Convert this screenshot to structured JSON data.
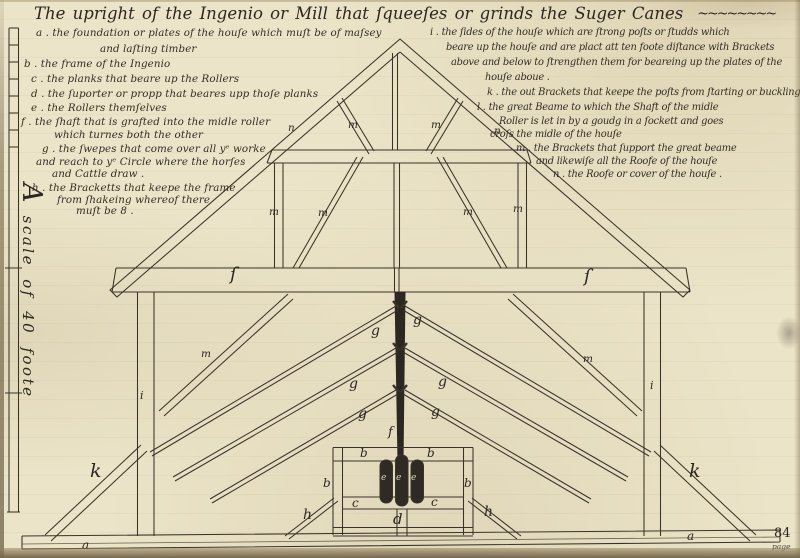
{
  "colors": {
    "paper": "#ece4c8",
    "ink": "#3a3328",
    "ink_dark": "#2c2720",
    "page_edge": "#75684e",
    "roller_fill": "#2f2a23",
    "label_light": "#d9d1b6"
  },
  "title": {
    "text": "The upright of the Ingenio or Mill that ſqueeſes or grinds the Suger Canes",
    "flourish": "~~~~~~~~"
  },
  "scale_note": {
    "text": "A scale of 40 foote"
  },
  "page": {
    "number": "84",
    "word": "page"
  },
  "legend_left": {
    "lines": [
      {
        "text": "a . the foundation or plates of the houſe which muſt be of maſsey",
        "x": 36,
        "y": 27
      },
      {
        "text": "and laſting timber",
        "x": 100,
        "y": 43
      },
      {
        "text": "b . the frame of the Ingenio",
        "x": 24,
        "y": 58
      },
      {
        "text": "c . the planks that beare up the Rollers",
        "x": 31,
        "y": 73
      },
      {
        "text": "d . the ſuporter or propp that beares upp thoſe planks",
        "x": 31,
        "y": 88
      },
      {
        "text": "e . the Rollers themſelves",
        "x": 31,
        "y": 102
      },
      {
        "text": "f . the ſhaft that is grafted into the midle roller",
        "x": 21,
        "y": 116
      },
      {
        "text": "which turnes both the other",
        "x": 54,
        "y": 129
      },
      {
        "text": "g . the ſwepes that come over all yᵉ worke",
        "x": 42,
        "y": 143
      },
      {
        "text": "and reach to yᵉ Circle where the horſes",
        "x": 36,
        "y": 156
      },
      {
        "text": "and Cattle draw .",
        "x": 52,
        "y": 168
      },
      {
        "text": "h . the Bracketts that keepe the frame",
        "x": 32,
        "y": 182
      },
      {
        "text": "from ſhakeing whereof there",
        "x": 57,
        "y": 194
      },
      {
        "text": "muſt be 8 .",
        "x": 76,
        "y": 205
      }
    ]
  },
  "legend_right": {
    "lines": [
      {
        "text": "i . the ſides of the houſe which are ſtrong poſts or ſtudds which",
        "x": 430,
        "y": 27
      },
      {
        "text": "beare up the houſe and are plact att ten foote diſtance with Brackets",
        "x": 446,
        "y": 42
      },
      {
        "text": "above and below to ſtrengthen them for beareing up the plates of the",
        "x": 451,
        "y": 57
      },
      {
        "text": "houſe aboue .",
        "x": 485,
        "y": 72
      },
      {
        "text": "k . the out Brackets that keepe the poſts from ſtarting or buckling",
        "x": 487,
        "y": 87
      },
      {
        "text": "l . the great Beame to which the Shaft of the midle",
        "x": 477,
        "y": 102
      },
      {
        "text": "Roller is let in by a goudg in a ſockett and goes",
        "x": 499,
        "y": 116
      },
      {
        "text": "croſs the midle of the houſe",
        "x": 490,
        "y": 129
      },
      {
        "text": "m . the Brackets that ſupport the great beame",
        "x": 516,
        "y": 143
      },
      {
        "text": "and likewiſe all the Roofe of the houſe",
        "x": 536,
        "y": 156
      },
      {
        "text": "n . the Roofe or cover of the houſe .",
        "x": 553,
        "y": 169
      }
    ]
  },
  "diagram": {
    "labels": [
      {
        "t": "a",
        "x": 82,
        "y": 539,
        "fs": 12
      },
      {
        "t": "a",
        "x": 687,
        "y": 530,
        "fs": 12
      },
      {
        "t": "b",
        "x": 360,
        "y": 447,
        "fs": 12
      },
      {
        "t": "b",
        "x": 427,
        "y": 447,
        "fs": 12
      },
      {
        "t": "b",
        "x": 323,
        "y": 477,
        "fs": 12
      },
      {
        "t": "b",
        "x": 464,
        "y": 477,
        "fs": 12
      },
      {
        "t": "c",
        "x": 352,
        "y": 497,
        "fs": 12
      },
      {
        "t": "c",
        "x": 431,
        "y": 496,
        "fs": 12
      },
      {
        "t": "d",
        "x": 393,
        "y": 512,
        "fs": 15
      },
      {
        "t": "e",
        "x": 381,
        "y": 474,
        "fs": 9,
        "cls": "light"
      },
      {
        "t": "e",
        "x": 396,
        "y": 474,
        "fs": 9,
        "cls": "light"
      },
      {
        "t": "e",
        "x": 411,
        "y": 474,
        "fs": 9,
        "cls": "light"
      },
      {
        "t": "f",
        "x": 388,
        "y": 426,
        "fs": 13
      },
      {
        "t": "g",
        "x": 371,
        "y": 324,
        "fs": 14
      },
      {
        "t": "g",
        "x": 413,
        "y": 313,
        "fs": 14
      },
      {
        "t": "g",
        "x": 349,
        "y": 377,
        "fs": 14
      },
      {
        "t": "g",
        "x": 438,
        "y": 375,
        "fs": 14
      },
      {
        "t": "g",
        "x": 358,
        "y": 407,
        "fs": 14
      },
      {
        "t": "g",
        "x": 431,
        "y": 405,
        "fs": 14
      },
      {
        "t": "h",
        "x": 303,
        "y": 508,
        "fs": 14
      },
      {
        "t": "h",
        "x": 484,
        "y": 505,
        "fs": 14
      },
      {
        "t": "i",
        "x": 140,
        "y": 390,
        "fs": 11
      },
      {
        "t": "i",
        "x": 650,
        "y": 380,
        "fs": 11
      },
      {
        "t": "k",
        "x": 90,
        "y": 462,
        "fs": 19
      },
      {
        "t": "k",
        "x": 689,
        "y": 462,
        "fs": 19
      },
      {
        "t": "ſ",
        "x": 230,
        "y": 266,
        "fs": 18
      },
      {
        "t": "ſ",
        "x": 584,
        "y": 268,
        "fs": 18
      },
      {
        "t": "m",
        "x": 269,
        "y": 207,
        "fs": 10.5
      },
      {
        "t": "m",
        "x": 318,
        "y": 208,
        "fs": 10.5
      },
      {
        "t": "m",
        "x": 348,
        "y": 120,
        "fs": 10.5
      },
      {
        "t": "m",
        "x": 431,
        "y": 120,
        "fs": 10.5
      },
      {
        "t": "m",
        "x": 463,
        "y": 207,
        "fs": 10.5
      },
      {
        "t": "m",
        "x": 513,
        "y": 204,
        "fs": 10.5
      },
      {
        "t": "m",
        "x": 201,
        "y": 349,
        "fs": 10.5
      },
      {
        "t": "m",
        "x": 583,
        "y": 354,
        "fs": 10.5
      },
      {
        "t": "n",
        "x": 288,
        "y": 123,
        "fs": 10.5
      },
      {
        "t": "n",
        "x": 494,
        "y": 126,
        "fs": 10.5
      }
    ]
  }
}
